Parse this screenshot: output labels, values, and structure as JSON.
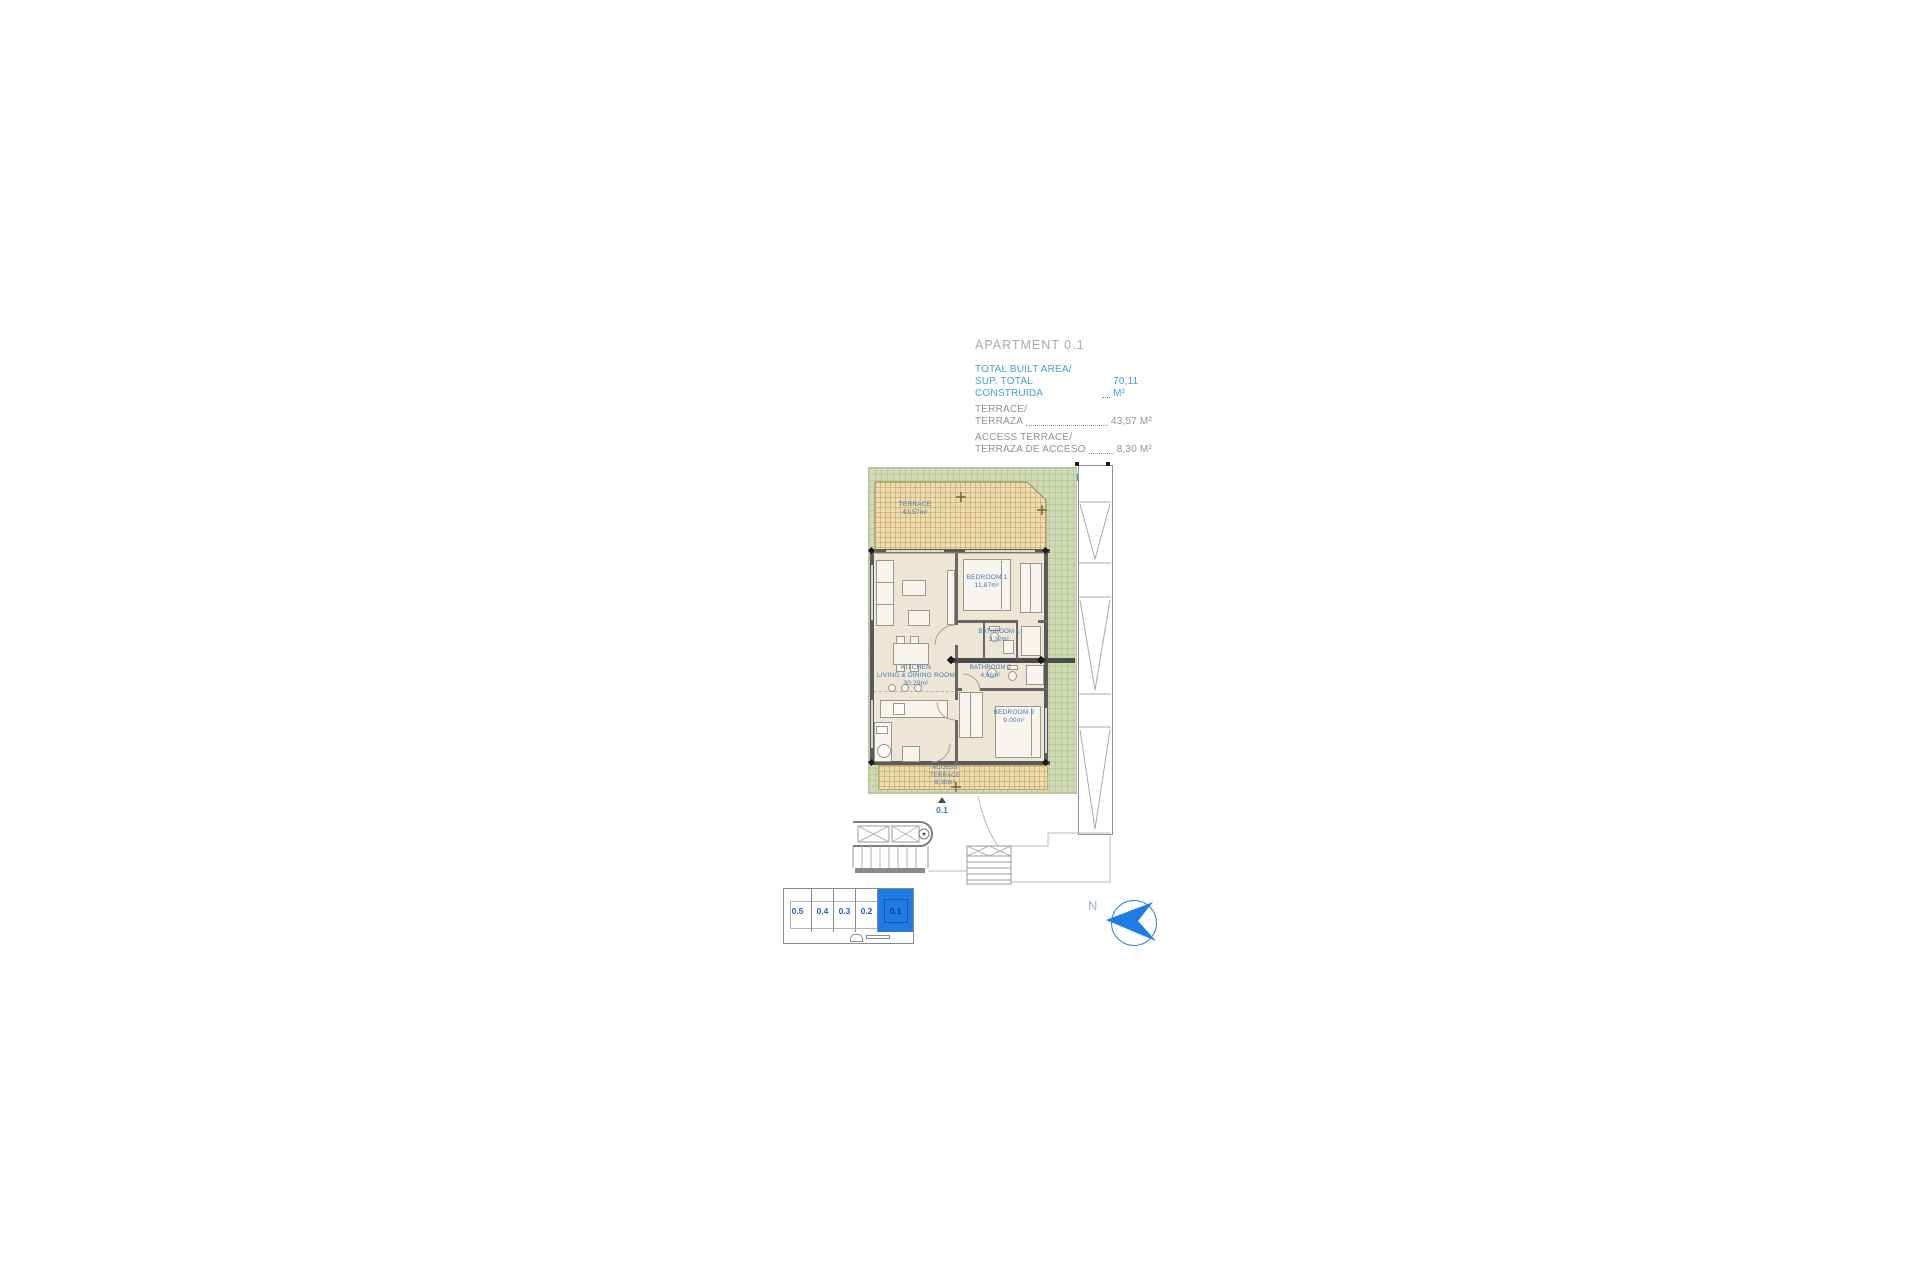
{
  "header": {
    "title": "APARTMENT 0.1",
    "areas": [
      {
        "label1": "TOTAL BUILT AREA/",
        "label2": "SUP. TOTAL CONSTRUIDA",
        "value": "70,11 M²"
      },
      {
        "label1": "TERRACE/",
        "label2": "TERRAZA",
        "value": "43,57 M²"
      },
      {
        "label1": "ACCESS TERRACE/",
        "label2": "TERRAZA DE ACCESO",
        "value": "8,30 M²"
      }
    ],
    "total_label": "TOTAL",
    "total_value": "121,98 M²"
  },
  "plan": {
    "terrace": {
      "name": "TERRACE",
      "area": "43,57m²"
    },
    "bedroom1": {
      "name": "BEDROOM 1",
      "area": "11,87m²"
    },
    "bathroom1": {
      "name": "BATHROOM 1",
      "area": "3,52m²"
    },
    "bathroom2": {
      "name": "BATHROOM 2",
      "area": "4,66m²"
    },
    "kitchen": {
      "name_line1": "KITCHEN",
      "name_line2": "LIVING & DINING ROOM",
      "area": "30,29m²"
    },
    "bedroom2": {
      "name": "BEDROOM 2",
      "area": "9,00m²"
    },
    "access_terrace": {
      "name_line1": "ACCESS",
      "name_line2": "TERRACE",
      "area": "8,30m²"
    },
    "unit_marker": "0.1"
  },
  "keyplan": {
    "units": [
      {
        "label": "0.5",
        "selected": false
      },
      {
        "label": "0.4",
        "selected": false
      },
      {
        "label": "0.3",
        "selected": false
      },
      {
        "label": "0.2",
        "selected": false
      },
      {
        "label": "0.1",
        "selected": true
      }
    ]
  },
  "compass": {
    "north_label": "N"
  },
  "colors": {
    "accent_blue": "#449fd8",
    "highlight_blue": "#1e7ce2",
    "plan_label_blue": "#4177b8",
    "garden_green": "#cfd9b4",
    "terrace_tan": "#eddcae",
    "wall_gray": "#5a5a5a"
  }
}
